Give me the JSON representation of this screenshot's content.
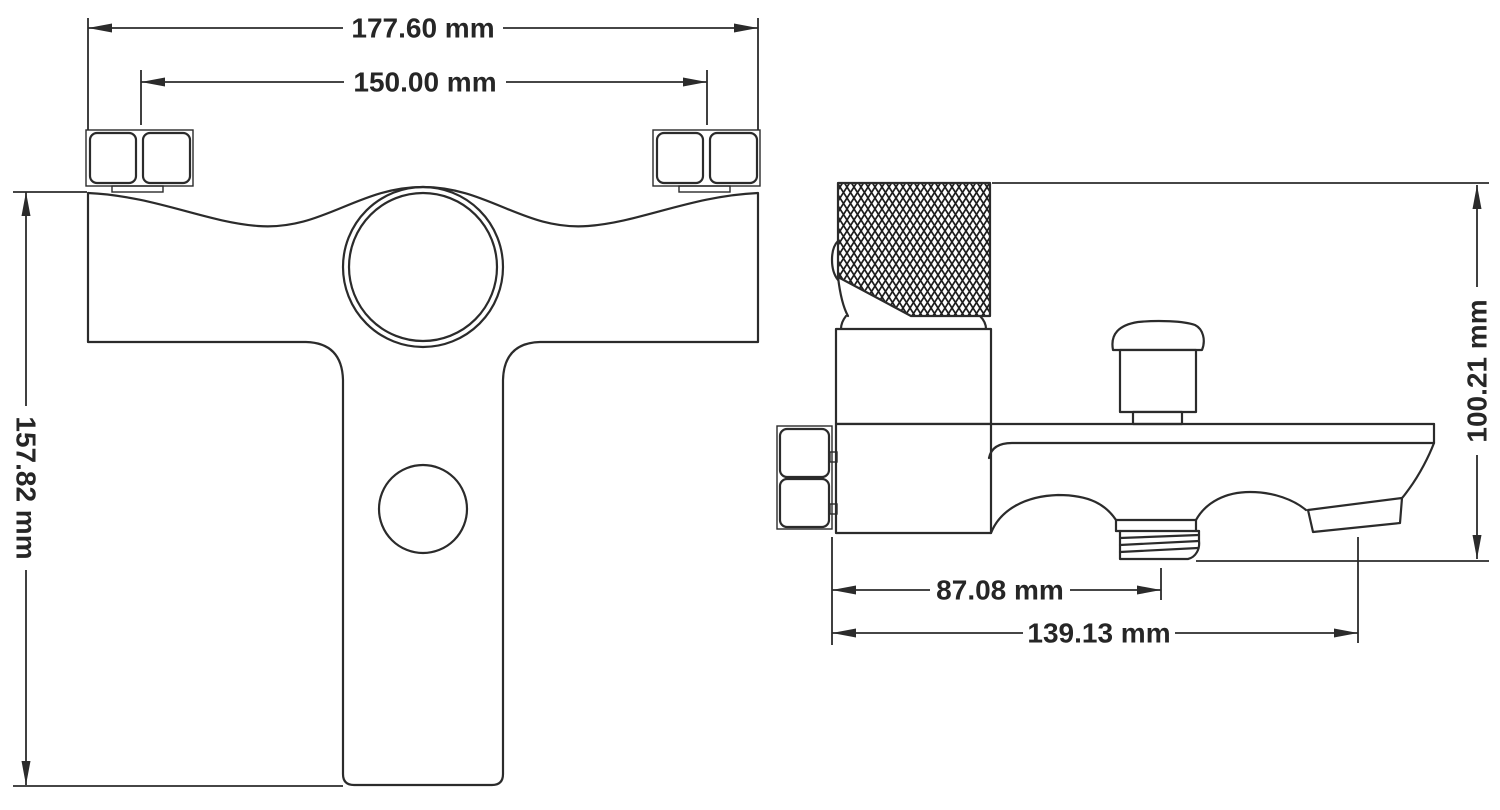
{
  "front_view": {
    "overall_width": "177.60 mm",
    "hole_spacing": "150.00 mm",
    "overall_height": "157.82 mm"
  },
  "side_view": {
    "overall_height": "100.21 mm",
    "shower_outlet_offset": "87.08 mm",
    "spout_reach": "139.13 mm"
  },
  "colors": {
    "line": "#2b2b2b",
    "background": "#ffffff"
  }
}
